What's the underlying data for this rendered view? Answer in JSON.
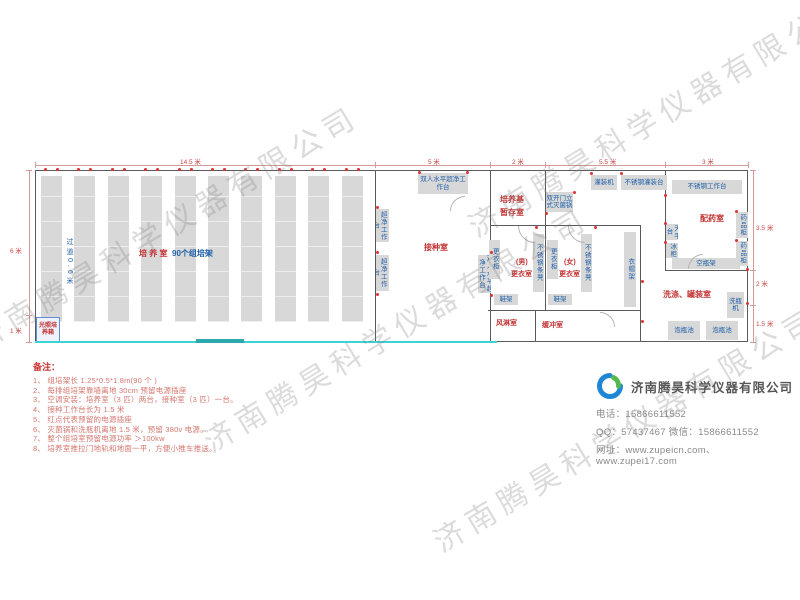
{
  "watermark": {
    "text": "济南腾昊科学仪器有限公司",
    "positions": [
      {
        "x": -25,
        "y": 318
      },
      {
        "x": 205,
        "y": 420
      },
      {
        "x": 435,
        "y": 520
      },
      {
        "x": 470,
        "y": 205
      }
    ]
  },
  "plan": {
    "racks": {
      "count": 10,
      "x0": 41,
      "step": 33.4,
      "w": 21,
      "y": 176,
      "h": 146
    },
    "aisle_text": {
      "text": "过道0.6米",
      "x": 64,
      "y": 238,
      "h": 66
    },
    "walls": [
      {
        "x": 35,
        "y": 170,
        "w": 713,
        "h": 1
      },
      {
        "x": 35,
        "y": 170,
        "w": 1,
        "h": 172
      },
      {
        "x": 747,
        "y": 170,
        "w": 1,
        "h": 172
      },
      {
        "x": 497,
        "y": 341,
        "w": 251,
        "h": 1
      },
      {
        "x": 375,
        "y": 170,
        "w": 1,
        "h": 172
      },
      {
        "x": 490,
        "y": 170,
        "w": 1,
        "h": 172
      },
      {
        "x": 545,
        "y": 170,
        "w": 1,
        "h": 56
      },
      {
        "x": 490,
        "y": 225,
        "w": 151,
        "h": 1
      },
      {
        "x": 545,
        "y": 225,
        "w": 1,
        "h": 86
      },
      {
        "x": 640,
        "y": 225,
        "w": 1,
        "h": 117
      },
      {
        "x": 488,
        "y": 310,
        "w": 153,
        "h": 1
      },
      {
        "x": 535,
        "y": 310,
        "w": 1,
        "h": 32
      },
      {
        "x": 665,
        "y": 170,
        "w": 1,
        "h": 100
      },
      {
        "x": 665,
        "y": 270,
        "w": 83,
        "h": 1
      }
    ],
    "floor_lines": [
      {
        "x": 35,
        "y": 341,
        "w": 462,
        "h": 2,
        "color": "#3fd2d2"
      },
      {
        "x": 196,
        "y": 339,
        "w": 48,
        "h": 4,
        "color": "#2ba9ad"
      }
    ],
    "equipment": [
      {
        "text": "光照培养箱",
        "x": 36,
        "y": 317,
        "w": 22,
        "h": 24,
        "o": "h",
        "special": "incubator"
      },
      {
        "text": "双人水平超净工作台",
        "x": 418,
        "y": 173,
        "w": 50,
        "h": 21,
        "o": "h"
      },
      {
        "text": "双人水平超净工作台",
        "x": 376,
        "y": 209,
        "w": 13,
        "h": 33,
        "o": "v"
      },
      {
        "text": "双人水平超净工作台",
        "x": 376,
        "y": 255,
        "w": 13,
        "h": 36,
        "o": "v"
      },
      {
        "text": "双人水平超净工作台",
        "x": 478,
        "y": 255,
        "w": 13,
        "h": 38,
        "o": "v"
      },
      {
        "text": "双开门立式灭菌锅",
        "x": 546,
        "y": 192,
        "w": 27,
        "h": 20,
        "o": "h"
      },
      {
        "text": "灌装机",
        "x": 591,
        "y": 175,
        "w": 26,
        "h": 15,
        "o": "h"
      },
      {
        "text": "不锈钢灌装台",
        "x": 621,
        "y": 175,
        "w": 46,
        "h": 15,
        "o": "h"
      },
      {
        "text": "更衣柜",
        "x": 489,
        "y": 240,
        "w": 11,
        "h": 39,
        "o": "v"
      },
      {
        "text": "不锈钢条凳",
        "x": 533,
        "y": 234,
        "w": 11,
        "h": 58,
        "o": "v"
      },
      {
        "text": "更衣柜",
        "x": 547,
        "y": 240,
        "w": 11,
        "h": 39,
        "o": "v"
      },
      {
        "text": "不锈钢条凳",
        "x": 581,
        "y": 234,
        "w": 11,
        "h": 58,
        "o": "v"
      },
      {
        "text": "衣帽架",
        "x": 624,
        "y": 232,
        "w": 12,
        "h": 75,
        "o": "v"
      },
      {
        "text": "鞋架",
        "x": 494,
        "y": 294,
        "w": 24,
        "h": 11,
        "o": "h"
      },
      {
        "text": "鞋架",
        "x": 548,
        "y": 294,
        "w": 24,
        "h": 11,
        "o": "h"
      },
      {
        "text": "不锈钢工作台",
        "x": 672,
        "y": 180,
        "w": 70,
        "h": 14,
        "o": "h"
      },
      {
        "text": "天平台",
        "x": 666,
        "y": 224,
        "w": 12,
        "h": 16,
        "o": "v"
      },
      {
        "text": "冰柜",
        "x": 666,
        "y": 243,
        "w": 12,
        "h": 15,
        "o": "v"
      },
      {
        "text": "药品柜",
        "x": 736,
        "y": 212,
        "w": 12,
        "h": 26,
        "o": "v"
      },
      {
        "text": "药品柜",
        "x": 736,
        "y": 241,
        "w": 12,
        "h": 25,
        "o": "v"
      },
      {
        "text": "空瓶架",
        "x": 672,
        "y": 258,
        "w": 68,
        "h": 11,
        "o": "h"
      },
      {
        "text": "洗瓶机",
        "x": 727,
        "y": 292,
        "w": 17,
        "h": 26,
        "o": "h"
      },
      {
        "text": "泡瓶池",
        "x": 668,
        "y": 321,
        "w": 32,
        "h": 19,
        "o": "h"
      },
      {
        "text": "泡瓶池",
        "x": 706,
        "y": 321,
        "w": 32,
        "h": 19,
        "o": "h"
      }
    ],
    "labels": [
      {
        "text": "培 养 室",
        "x": 139,
        "y": 248,
        "c": "red",
        "fs": 8
      },
      {
        "text": "90个组培架",
        "x": 172,
        "y": 248,
        "c": "blue",
        "fs": 8
      },
      {
        "text": "接种室",
        "x": 424,
        "y": 242,
        "c": "red",
        "fs": 8
      },
      {
        "text": "培养基",
        "x": 500,
        "y": 194,
        "c": "red",
        "fs": 8
      },
      {
        "text": "暂存室",
        "x": 500,
        "y": 207,
        "c": "red",
        "fs": 8
      },
      {
        "text": "(男)",
        "x": 516,
        "y": 257,
        "c": "red",
        "fs": 7
      },
      {
        "text": "更衣室",
        "x": 511,
        "y": 269,
        "c": "red",
        "fs": 7
      },
      {
        "text": "(女)",
        "x": 564,
        "y": 257,
        "c": "red",
        "fs": 7
      },
      {
        "text": "更衣室",
        "x": 559,
        "y": 269,
        "c": "red",
        "fs": 7
      },
      {
        "text": "风淋室",
        "x": 496,
        "y": 318,
        "c": "red",
        "fs": 7
      },
      {
        "text": "缓冲室",
        "x": 542,
        "y": 320,
        "c": "red",
        "fs": 7
      },
      {
        "text": "配药室",
        "x": 700,
        "y": 213,
        "c": "red",
        "fs": 8
      },
      {
        "text": "洗涤、罐装室",
        "x": 663,
        "y": 289,
        "c": "red",
        "fs": 8
      }
    ],
    "dims": {
      "top_line": {
        "x": 35,
        "y": 165,
        "w": 713
      },
      "top_ticks": [
        35,
        375,
        490,
        545,
        665,
        748
      ],
      "top_labels": [
        {
          "text": "14.5 米",
          "x": 180
        },
        {
          "text": "5 米",
          "x": 428
        },
        {
          "text": "2 米",
          "x": 512
        },
        {
          "text": "5.5 米",
          "x": 599
        },
        {
          "text": "3 米",
          "x": 702
        }
      ],
      "left_line": {
        "x": 29,
        "y": 170,
        "h": 172
      },
      "left_ticks": [
        170,
        315,
        342
      ],
      "left_labels": [
        {
          "text": "6 米",
          "y": 245
        },
        {
          "text": "1 米",
          "y": 325
        }
      ],
      "right_line": {
        "x": 753,
        "y": 170,
        "h": 172
      },
      "right_ticks": [
        170,
        270,
        305,
        342
      ],
      "right_labels": [
        {
          "text": "3.5 米",
          "y": 222
        },
        {
          "text": "2 米",
          "y": 278
        },
        {
          "text": "1.5 米",
          "y": 318
        }
      ]
    },
    "extra_dots": [
      [
        376,
        206
      ],
      [
        376,
        251
      ],
      [
        376,
        293
      ],
      [
        490,
        251
      ],
      [
        490,
        294
      ],
      [
        418,
        171
      ],
      [
        466,
        171
      ],
      [
        545,
        212
      ],
      [
        573,
        191
      ],
      [
        590,
        172
      ],
      [
        620,
        172
      ],
      [
        664,
        194
      ],
      [
        664,
        222
      ],
      [
        664,
        241
      ],
      [
        735,
        210
      ],
      [
        735,
        239
      ],
      [
        746,
        268
      ],
      [
        746,
        302
      ],
      [
        535,
        226
      ],
      [
        594,
        226
      ],
      [
        641,
        280
      ],
      [
        641,
        320
      ]
    ],
    "arcs": [
      {
        "x": 518,
        "y": 226,
        "s": 16,
        "t": "bl"
      },
      {
        "x": 568,
        "y": 226,
        "s": 16,
        "t": "bl"
      },
      {
        "x": 688,
        "y": 254,
        "s": 14,
        "t": "tl"
      },
      {
        "x": 600,
        "y": 312,
        "s": 14,
        "t": "tr"
      },
      {
        "x": 450,
        "y": 196,
        "s": 14,
        "t": "tl"
      }
    ]
  },
  "notes": {
    "title": "备注：",
    "items": [
      "1、 组培架长 1.25*0.5*1.8m(90 个 )",
      "2、 每排组培架靠墙离地 30cm 预留电源插座",
      "3、 空调安装：培养室（3 匹）两台，接种室（3 匹）一台。",
      "4、 接种工作台长为 1.5 米",
      "5、 红点代表预留的电源插座",
      "6、 灭菌锅和洗瓶机离地 1.5 米，预留 380v 电源。",
      "7、 整个组培室预留电源功率 ＞100kw",
      "8、 培养室推拉门地轨和地面一平，方便小推车推送。"
    ]
  },
  "company": {
    "name": "济南腾昊科学仪器有限公司",
    "contact": [
      "电话：15866611552",
      "QQ：57437467    微信：15866611552",
      "网址：www.zupeicn.com、www.zupei17.com"
    ],
    "logo_colors": {
      "blue": "#1f86d6",
      "green": "#55b84e"
    }
  },
  "colors": {
    "room_label_red": "#c23434",
    "equipment_label_blue": "#1f5fa8",
    "wall": "#5a5a5a",
    "rack_fill": "#d8d8d8",
    "floor_line_cyan": "#3fd2d2",
    "sliding_door_teal": "#2ba9ad",
    "power_dot_red": "#e03333",
    "note_red": "#d4766e"
  }
}
